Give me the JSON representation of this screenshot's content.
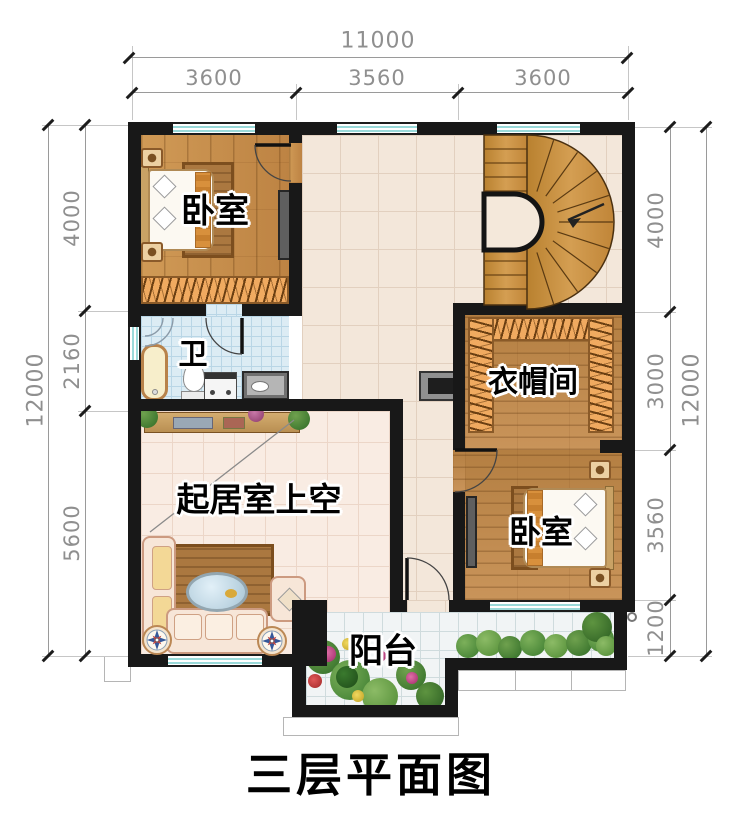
{
  "title": "三层平面图",
  "rooms": {
    "bedroom_top_left": "卧室",
    "bathroom": "卫",
    "cloakroom": "衣帽间",
    "living_room_void": "起居室上空",
    "bedroom_bottom_right": "卧室",
    "balcony": "阳台"
  },
  "dimensions": {
    "top": {
      "total": "11000",
      "segments": [
        "3600",
        "3560",
        "3600"
      ]
    },
    "left": {
      "total": "12000",
      "segments": [
        "4000",
        "2160",
        "5600"
      ]
    },
    "right": {
      "total": "12000",
      "segments": [
        "4000",
        "3000",
        "3560",
        "1200"
      ]
    }
  },
  "colors": {
    "wall": "#181818",
    "window_glass": "#9adada",
    "wood_floor": "#c8924f",
    "stair_wood": "#c98c42",
    "hall_tile": "#f3e7da",
    "living_tile": "#f9ece3",
    "bath_tile": "#dcecf4",
    "balcony_tile": "#f1f4f5",
    "dimension_text": "#8f8f8f"
  }
}
